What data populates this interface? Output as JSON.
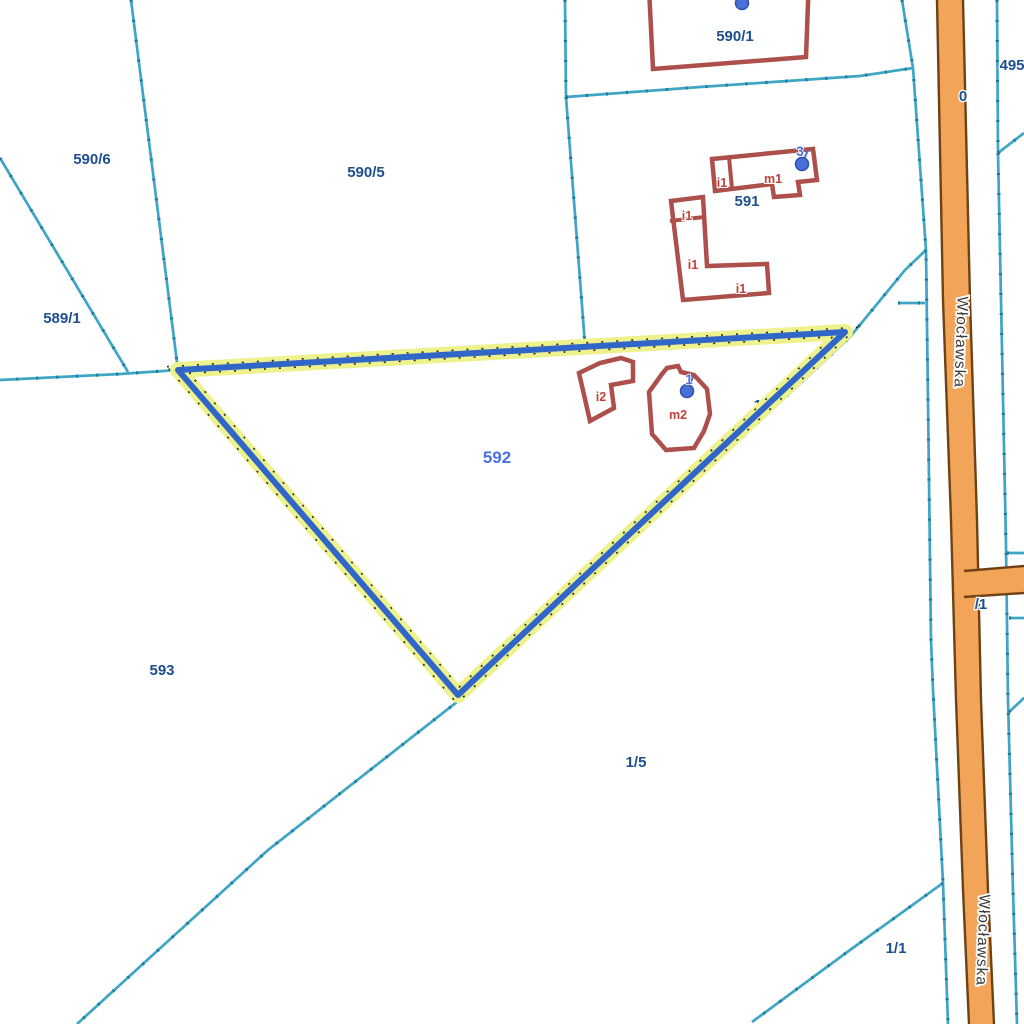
{
  "map": {
    "title": "cadastral-parcel-map",
    "colors": {
      "background": "#ffffff",
      "boundary": "#3fa5c5",
      "boundary_tick": "#1d7a9a",
      "building_stroke": "#ad4f4b",
      "building_fill": "#ffffff",
      "road_fill": "#f2a458",
      "road_border": "#6e4214",
      "selected_halo": "#eef28d",
      "selected_line": "#2f66c8",
      "selected_dots": "#2a2a2a",
      "parcel_label": "#1d4f8f",
      "selected_label": "#4a72e0",
      "building_label": "#c2403a",
      "address_label": "#4a6fd8",
      "road_label": "#3b3b3b"
    },
    "boundary_lines": [
      {
        "points": [
          [
            131,
            0
          ],
          [
            178,
            370
          ]
        ]
      },
      {
        "points": [
          [
            0,
            158
          ],
          [
            128,
            372
          ]
        ]
      },
      {
        "points": [
          [
            178,
            370
          ],
          [
            120,
            374
          ],
          [
            0,
            380
          ]
        ]
      },
      {
        "points": [
          [
            565,
            0
          ],
          [
            566,
            97
          ]
        ]
      },
      {
        "points": [
          [
            566,
            97
          ],
          [
            585,
            345
          ]
        ]
      },
      {
        "points": [
          [
            566,
            97
          ],
          [
            700,
            87
          ],
          [
            860,
            76
          ],
          [
            913,
            68
          ]
        ]
      },
      {
        "points": [
          [
            902,
            0
          ],
          [
            913,
            68
          ],
          [
            926,
            250
          ],
          [
            928,
            400
          ],
          [
            931,
            640
          ],
          [
            933,
            690
          ],
          [
            943,
            883
          ],
          [
            948,
            1024
          ]
        ]
      },
      {
        "points": [
          [
            926,
            250
          ],
          [
            905,
            270
          ],
          [
            850,
            337
          ],
          [
            462,
            698
          ],
          [
            268,
            850
          ],
          [
            77,
            1024
          ]
        ]
      },
      {
        "points": [
          [
            898,
            303
          ],
          [
            925,
            303
          ]
        ]
      },
      {
        "points": [
          [
            997,
            0
          ],
          [
            998,
            153
          ]
        ]
      },
      {
        "points": [
          [
            998,
            153
          ],
          [
            1024,
            133
          ]
        ]
      },
      {
        "points": [
          [
            998,
            153
          ],
          [
            1001,
            300
          ],
          [
            1006,
            545
          ],
          [
            1008,
            700
          ],
          [
            1013,
            890
          ],
          [
            1017,
            1024
          ]
        ]
      },
      {
        "points": [
          [
            1007,
            553
          ],
          [
            1024,
            553
          ]
        ]
      },
      {
        "points": [
          [
            1009,
            618
          ],
          [
            1024,
            618
          ]
        ]
      },
      {
        "points": [
          [
            1009,
            712
          ],
          [
            1024,
            698
          ]
        ]
      },
      {
        "points": [
          [
            943,
            883
          ],
          [
            850,
            950
          ],
          [
            752,
            1022
          ]
        ]
      }
    ],
    "road": {
      "name": "Włocławska",
      "left_edge": [
        [
          937,
          0
        ],
        [
          943,
          300
        ],
        [
          951,
          520
        ],
        [
          956,
          700
        ],
        [
          963,
          890
        ],
        [
          969,
          1024
        ]
      ],
      "right_edge": [
        [
          963,
          0
        ],
        [
          970,
          300
        ],
        [
          977,
          520
        ],
        [
          981,
          700
        ],
        [
          988,
          890
        ],
        [
          994,
          1024
        ]
      ],
      "spur_top": [
        [
          964,
          571
        ],
        [
          1024,
          566
        ]
      ],
      "spur_bottom": [
        [
          964,
          597
        ],
        [
          1024,
          593
        ]
      ]
    },
    "selected_parcel": {
      "number": "592",
      "points": [
        [
          178,
          370
        ],
        [
          845,
          332
        ],
        [
          458,
          695
        ]
      ]
    },
    "buildings": [
      {
        "id": "bldg-590-1",
        "points": [
          [
            649,
            -12
          ],
          [
            809,
            -24
          ],
          [
            806,
            57
          ],
          [
            653,
            69
          ]
        ],
        "dividers": []
      },
      {
        "id": "bldg-m1",
        "points": [
          [
            712,
            159
          ],
          [
            813,
            149
          ],
          [
            817,
            180
          ],
          [
            798,
            182
          ],
          [
            800,
            195
          ],
          [
            774,
            197
          ],
          [
            772,
            184
          ],
          [
            715,
            191
          ]
        ],
        "dividers": [
          [
            [
              729,
              157
            ],
            [
              732,
              189
            ]
          ]
        ]
      },
      {
        "id": "bldg-i1-L",
        "points": [
          [
            671,
            201
          ],
          [
            703,
            197
          ],
          [
            707,
            266
          ],
          [
            767,
            264
          ],
          [
            769,
            293
          ],
          [
            683,
            300
          ]
        ],
        "dividers": [
          [
            [
              670,
              221
            ],
            [
              704,
              217
            ]
          ]
        ]
      },
      {
        "id": "bldg-i2",
        "points": [
          [
            579,
            373
          ],
          [
            600,
            363
          ],
          [
            621,
            358
          ],
          [
            633,
            362
          ],
          [
            633,
            381
          ],
          [
            611,
            385
          ],
          [
            614,
            408
          ],
          [
            590,
            421
          ]
        ],
        "dividers": []
      },
      {
        "id": "bldg-m2",
        "points": [
          [
            662,
            374
          ],
          [
            667,
            368
          ],
          [
            678,
            366
          ],
          [
            681,
            372
          ],
          [
            694,
            375
          ],
          [
            707,
            389
          ],
          [
            710,
            414
          ],
          [
            704,
            431
          ],
          [
            694,
            448
          ],
          [
            666,
            450
          ],
          [
            652,
            434
          ],
          [
            649,
            392
          ],
          [
            657,
            381
          ]
        ],
        "dividers": []
      }
    ],
    "labels_under": [
      {
        "text": "1/3",
        "x": 764,
        "y": 410,
        "cls": "parcel"
      }
    ],
    "labels": [
      {
        "text": "590/1",
        "x": 735,
        "y": 41,
        "cls": "parcel"
      },
      {
        "text": "590/6",
        "x": 92,
        "y": 164,
        "cls": "parcel"
      },
      {
        "text": "590/5",
        "x": 366,
        "y": 177,
        "cls": "parcel"
      },
      {
        "text": "589/1",
        "x": 62,
        "y": 323,
        "cls": "parcel"
      },
      {
        "text": "591",
        "x": 747,
        "y": 206,
        "cls": "parcel"
      },
      {
        "text": "593",
        "x": 162,
        "y": 675,
        "cls": "parcel"
      },
      {
        "text": "1/5",
        "x": 636,
        "y": 767,
        "cls": "parcel"
      },
      {
        "text": "1/1",
        "x": 896,
        "y": 953,
        "cls": "parcel"
      },
      {
        "text": "495",
        "x": 1012,
        "y": 70,
        "cls": "parcel"
      },
      {
        "text": "0",
        "x": 963,
        "y": 101,
        "cls": "parcel"
      },
      {
        "text": "/1",
        "x": 981,
        "y": 609,
        "cls": "parcel"
      },
      {
        "text": "592",
        "x": 497,
        "y": 463,
        "cls": "selected"
      },
      {
        "text": "i1",
        "x": 722,
        "y": 187,
        "cls": "building"
      },
      {
        "text": "m1",
        "x": 773,
        "y": 183,
        "cls": "building"
      },
      {
        "text": "i1",
        "x": 687,
        "y": 220,
        "cls": "building"
      },
      {
        "text": "i1",
        "x": 693,
        "y": 269,
        "cls": "building"
      },
      {
        "text": "i1",
        "x": 741,
        "y": 293,
        "cls": "building"
      },
      {
        "text": "i2",
        "x": 601,
        "y": 401,
        "cls": "building"
      },
      {
        "text": "m2",
        "x": 678,
        "y": 419,
        "cls": "building"
      },
      {
        "text": "3",
        "x": 800,
        "y": 156,
        "cls": "address"
      },
      {
        "text": "1",
        "x": 689,
        "y": 384,
        "cls": "address"
      },
      {
        "text": "Włocławska",
        "x": 956,
        "y": 342,
        "cls": "road",
        "rotate": 92
      },
      {
        "text": "Włocławska",
        "x": 978,
        "y": 940,
        "cls": "road",
        "rotate": 92
      }
    ],
    "address_markers": [
      {
        "x": 742,
        "y": 3
      },
      {
        "x": 802,
        "y": 164
      },
      {
        "x": 687,
        "y": 391
      }
    ]
  }
}
